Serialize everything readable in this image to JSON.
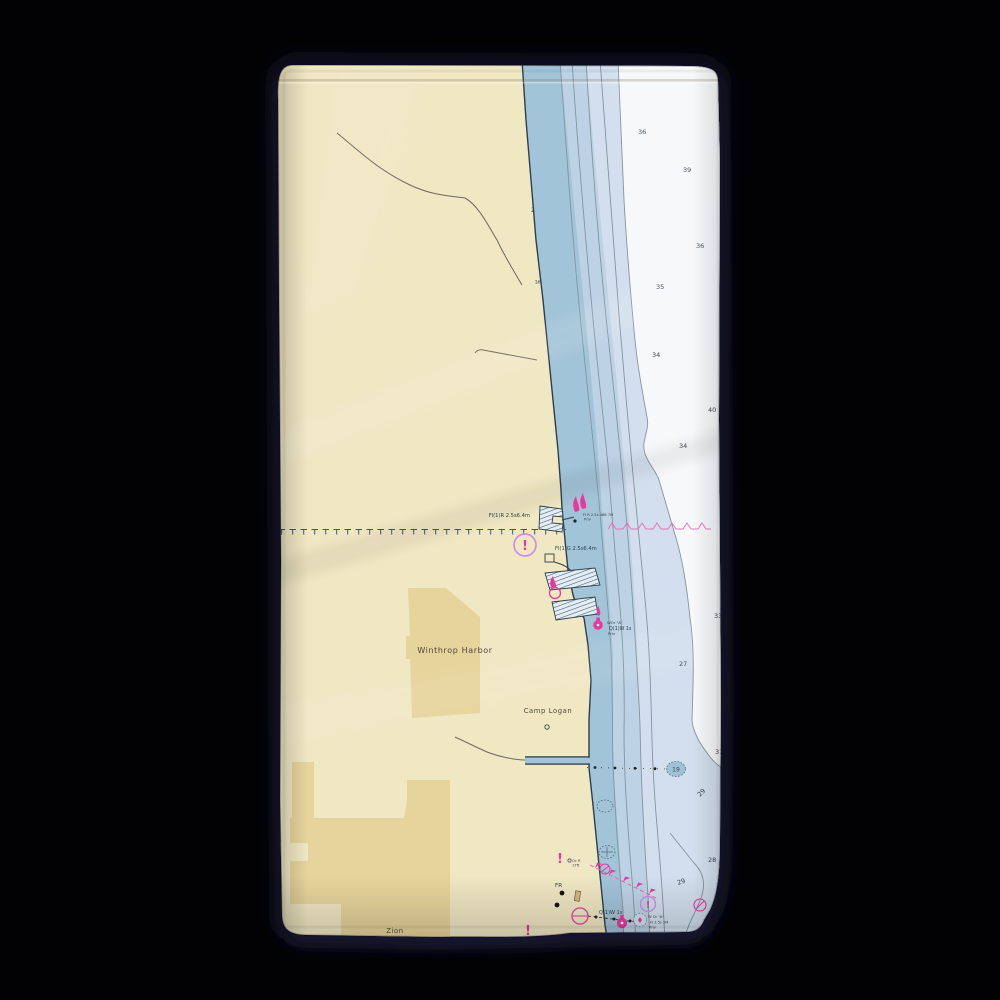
{
  "scene": {
    "background_color": "#020204",
    "shadow_color": "#1a1a38",
    "product": "Beach towel printed with a nautical chart"
  },
  "chart": {
    "region": "Winthrop Harbor / Zion shoreline, Lake Michigan",
    "colors": {
      "land": "#f0e7c3",
      "urban": "#e7d49c",
      "water_nearshore": "#a2c4d8",
      "water_mid": "#bdd3e5",
      "water_outer": "#d3dfee",
      "deep_water": "#f7f8fa",
      "contour_line": "#8493a0",
      "shoreline": "#2f3e4a",
      "magenta": "#e83a9e",
      "caution_ring": "#cf8fe0",
      "ink": "#3a4550"
    },
    "labels": {
      "winthrop_harbor": "Winthrop Harbor",
      "camp_logan": "Camp Logan",
      "zion": "Zion"
    },
    "nav": {
      "north_breakwater_light": "Fl(1)R 2.5s6.4m",
      "south_pier_light": "Fl(1)G 2.5s6.4m",
      "north_light_detail": "Fl R 2.5s 46ft 7M",
      "private_note": "Priv",
      "mooring_buoy_name": "WOr \"A\"",
      "mooring_buoy_char": "Q(1)W 1s",
      "fixed_red_light": "FR",
      "tank_light_line1": "Oc R",
      "tank_light_line2": "17ft",
      "south_range_char": "Q(1)W 1s",
      "south_buoy_name": "W Or \"A\"",
      "south_buoy_char": "Fl 2.5s 2M",
      "caution_mark": "!"
    },
    "soundings": [
      "2",
      "36",
      "36",
      "39",
      "36",
      "35",
      "34",
      "40",
      "34",
      "33",
      "27",
      "31",
      "19",
      "29",
      "28",
      "29"
    ]
  }
}
